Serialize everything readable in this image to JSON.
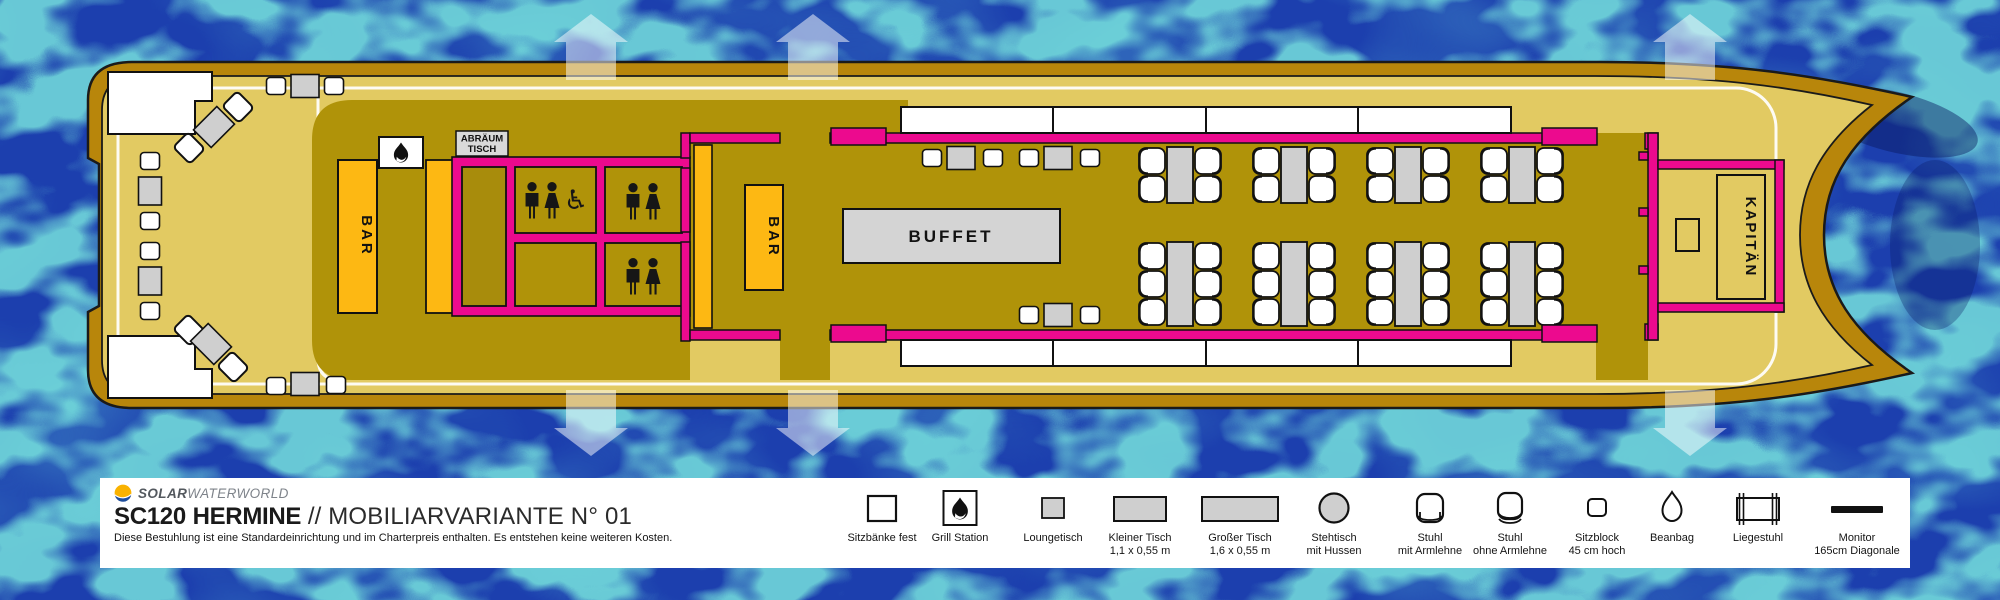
{
  "header": {
    "brand_bold": "SOLAR",
    "brand_light": "WATERWORLD",
    "model": "SC120",
    "name": "HERMINE",
    "sep": "//",
    "variant": "MOBILIARVARIANTE N° 01",
    "subtitle": "Diese Bestuhlung ist eine Standardeinrichtung und im Charterpreis enthalten. Es entstehen keine weiteren Kosten."
  },
  "plan": {
    "bar_left_label": "BAR",
    "bar_salon_label": "BAR",
    "buffet_label": "BUFFET",
    "clearing_table_line1": "ABRÄUM",
    "clearing_table_line2": "TISCH",
    "captain_label": "KAPITÄN",
    "wheelchair_glyph": "♿"
  },
  "legend": {
    "items": [
      {
        "icon": "bench-icon",
        "line1": "Sitzbänke fest",
        "line2": ""
      },
      {
        "icon": "grill-icon",
        "line1": "Grill Station",
        "line2": ""
      },
      {
        "icon": "lounge-table-icon",
        "line1": "Loungetisch",
        "line2": ""
      },
      {
        "icon": "small-table-icon",
        "line1": "Kleiner Tisch",
        "line2": "1,1 x 0,55 m"
      },
      {
        "icon": "large-table-icon",
        "line1": "Großer Tisch",
        "line2": "1,6 x 0,55 m"
      },
      {
        "icon": "standing-table-icon",
        "line1": "Stehtisch",
        "line2": "mit Hussen"
      },
      {
        "icon": "chair-armrest-icon",
        "line1": "Stuhl",
        "line2": "mit Armlehne"
      },
      {
        "icon": "chair-no-armrest-icon",
        "line1": "Stuhl",
        "line2": "ohne Armlehne"
      },
      {
        "icon": "seat-block-icon",
        "line1": "Sitzblock",
        "line2": "45 cm hoch"
      },
      {
        "icon": "beanbag-icon",
        "line1": "Beanbag",
        "line2": ""
      },
      {
        "icon": "deckchair-icon",
        "line1": "Liegestuhl",
        "line2": ""
      },
      {
        "icon": "monitor-icon",
        "line1": "Monitor",
        "line2": "165cm Diagonale"
      }
    ]
  },
  "colors": {
    "water": "#1c3fae",
    "water_vein": "#2fbfc0",
    "hull": "#b8860b",
    "deck": "#e2ca62",
    "cabin_floor": "#b09309",
    "wall_pink": "#ec0a8e",
    "bar_yellow": "#fdb813",
    "furniture_gray": "#cfcfcf",
    "accent_white": "#ffffff"
  }
}
